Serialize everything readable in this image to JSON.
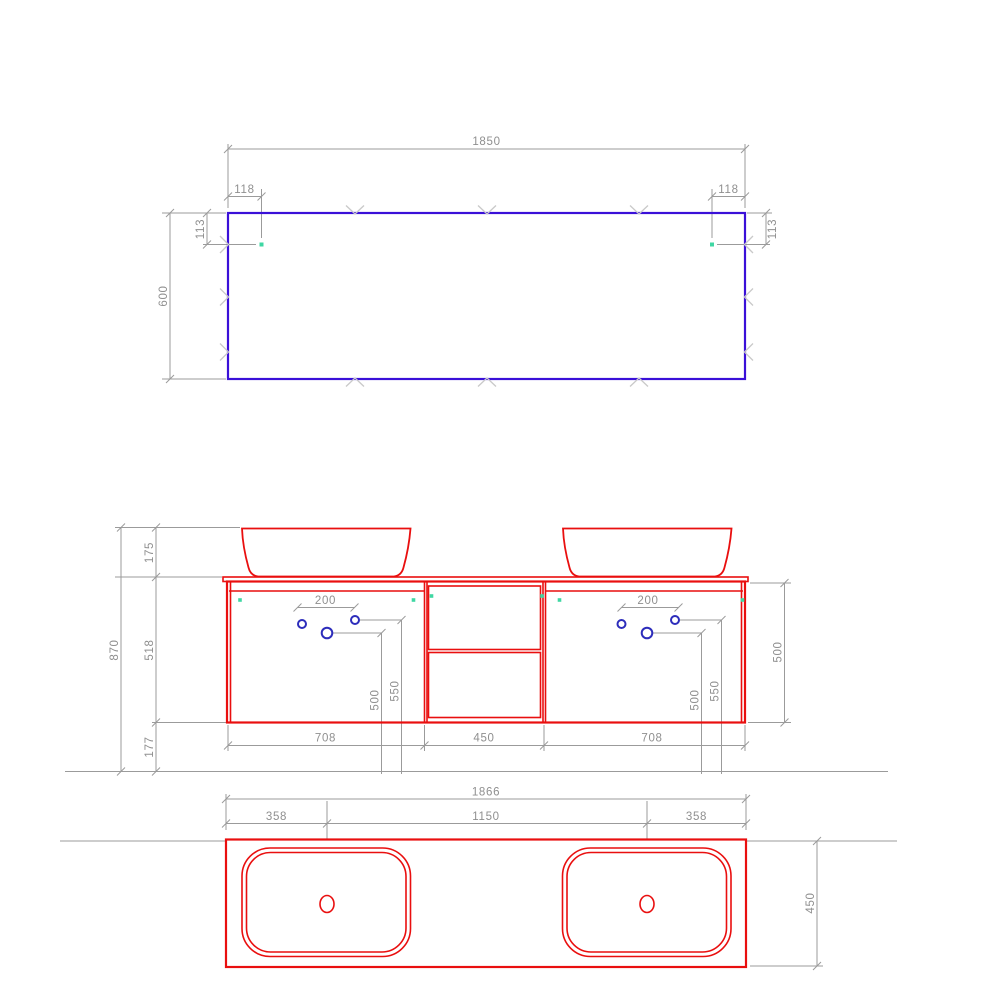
{
  "drawing_title": "Double vanity unit technical drawing (mirror, front elevation, countertop plan)",
  "colors": {
    "c-red": "#e90f0f",
    "c-blue": "#2d2dbb",
    "c-mirror": "#3a10d8",
    "c-green": "#3fd7a3",
    "c-dim": "#9b9b9b",
    "c-mark": "#c9c9c9",
    "c-text": "#8f8f8f",
    "c-bg": "#ffffff"
  },
  "views": {
    "mirror": {
      "width": "1850",
      "hole_offset_x": "118",
      "hole_offset_y": "113",
      "height": "600"
    },
    "front": {
      "total_height": "870",
      "basin_height": "175",
      "counter_and_cabinet_height": "518",
      "floor_clearance": "177",
      "faucet_hole_spacing": "200",
      "center_hole_height": "500",
      "outer_hole_height": "550",
      "cabinet_height": "500",
      "left_cabinet_width": "708",
      "drawer_unit_width": "450",
      "right_cabinet_width": "708"
    },
    "plan": {
      "total_width": "1866",
      "basin_center_offset": "358",
      "basin_center_spacing": "1150",
      "depth": "450"
    }
  }
}
